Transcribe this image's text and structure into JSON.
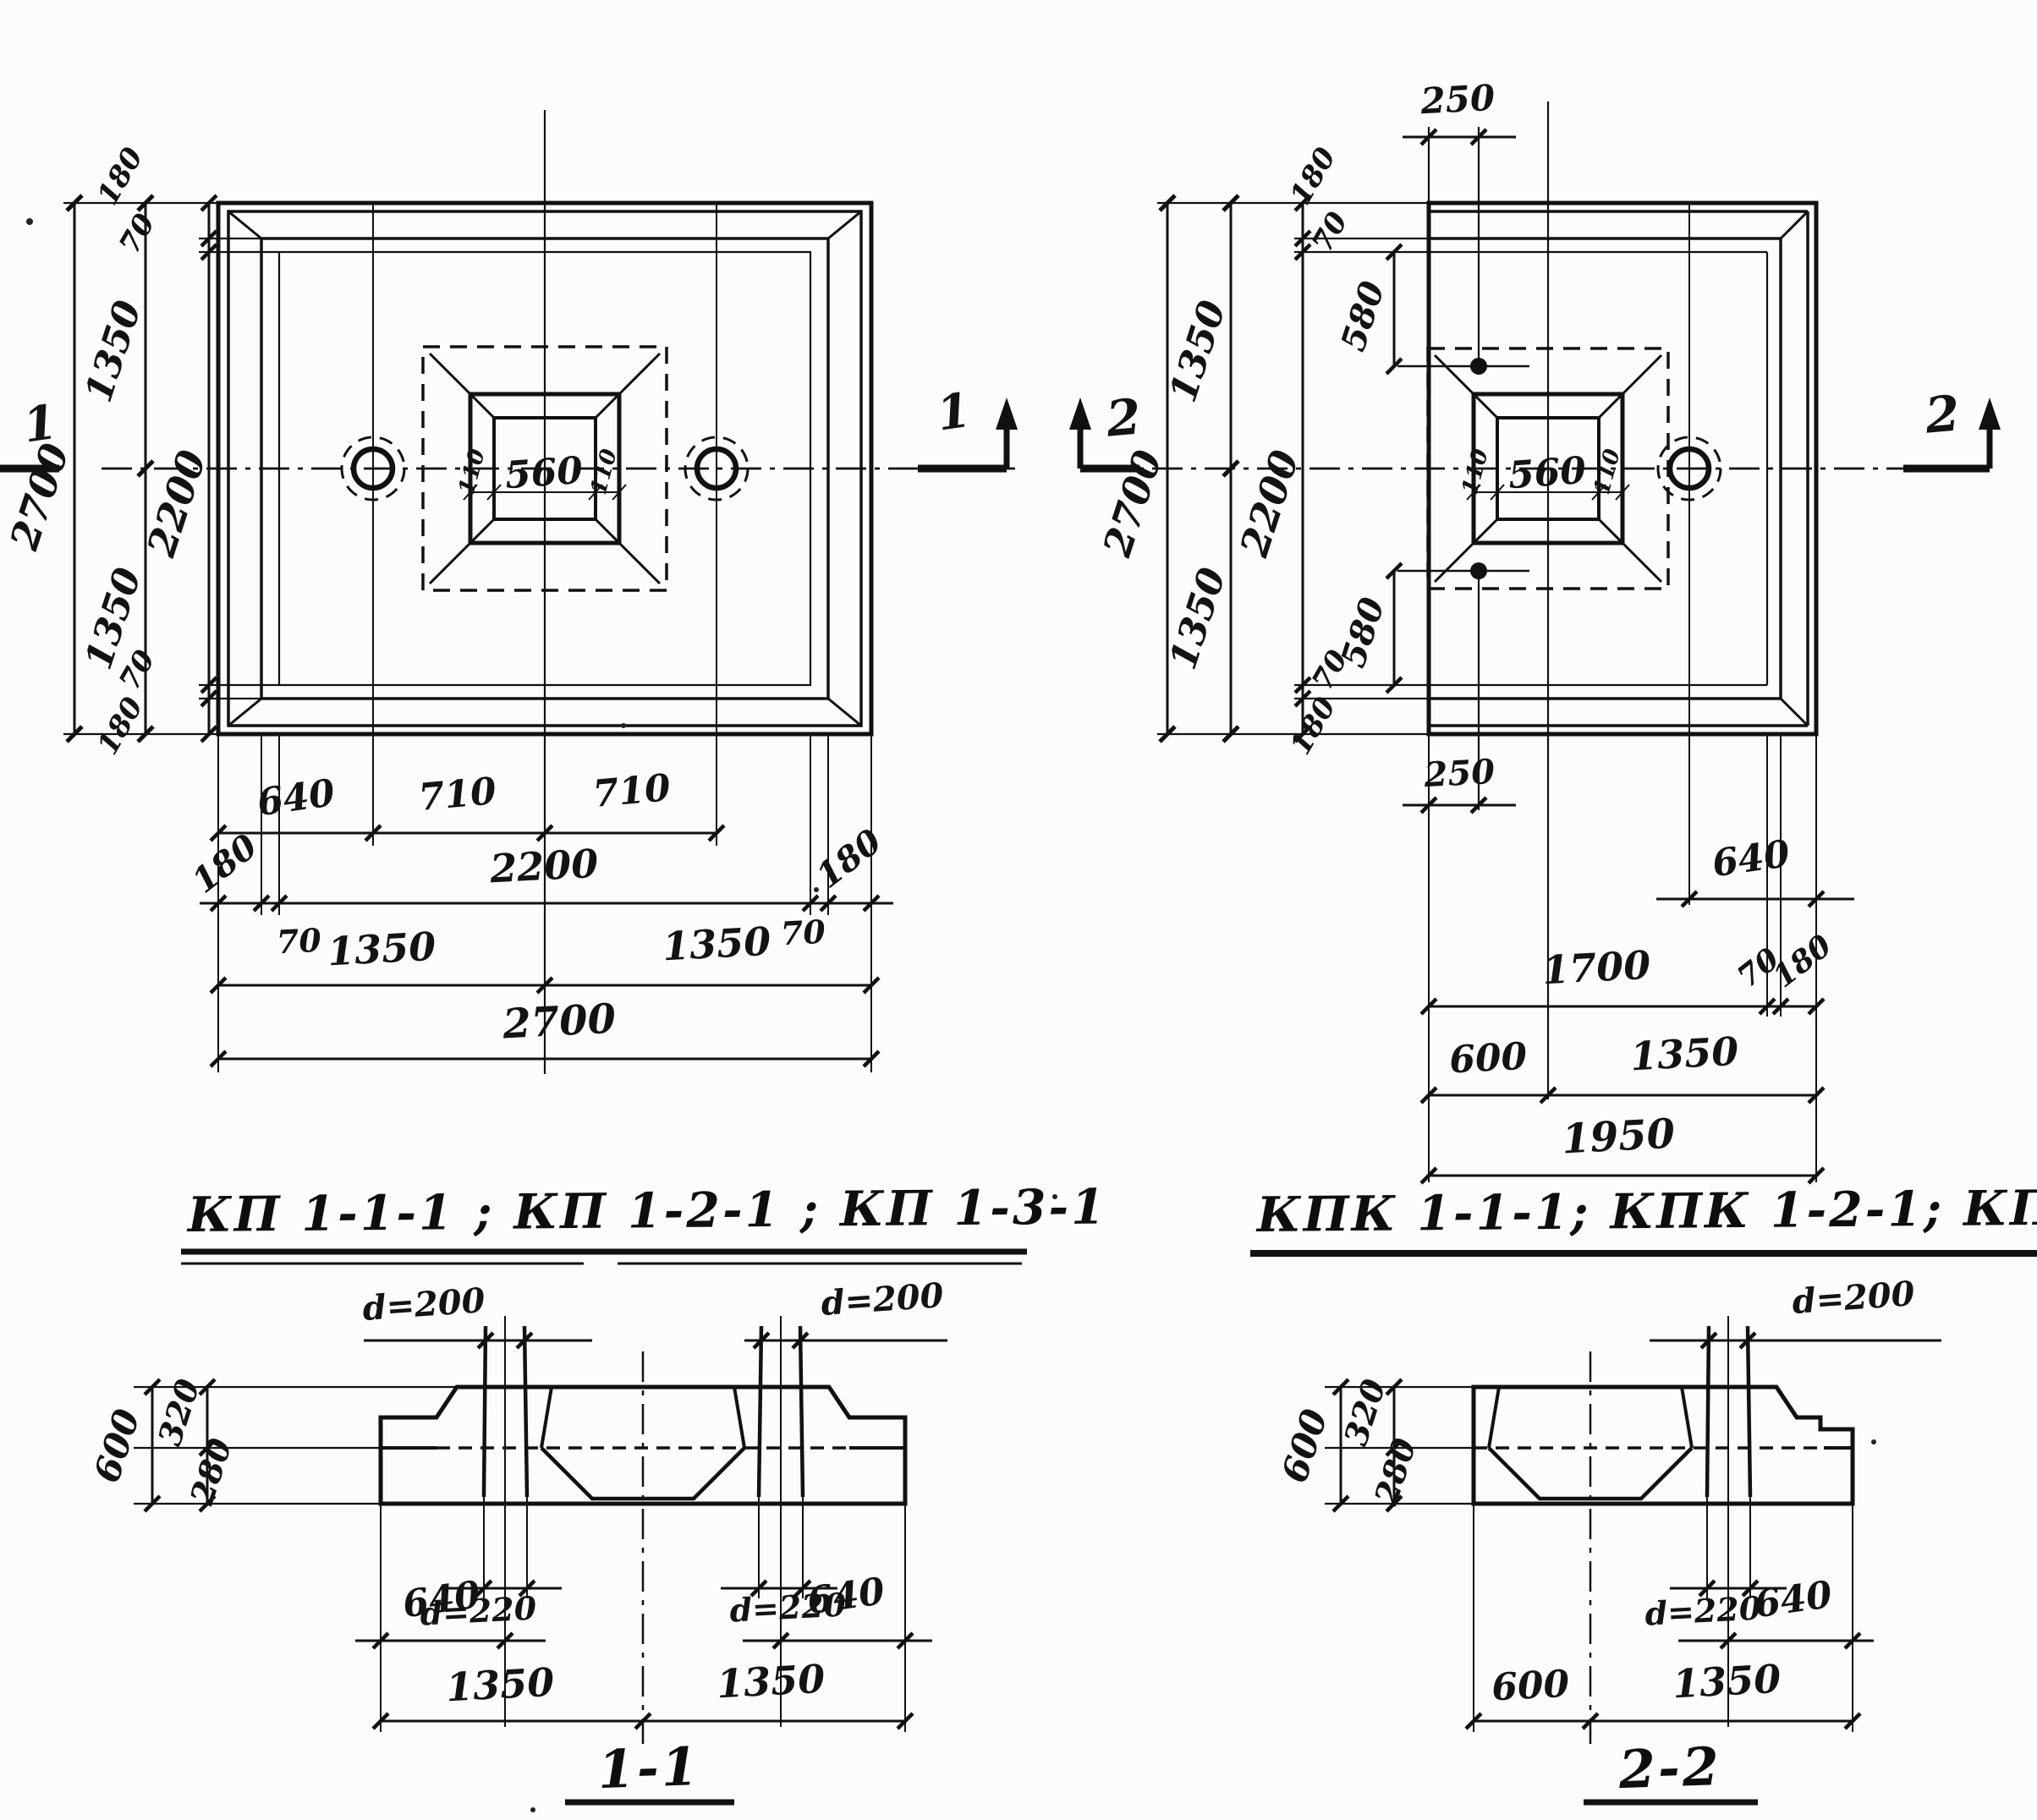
{
  "titles": {
    "kp": "КП 1-1-1 ; КП 1-2-1 ;  КП 1-3-1",
    "kpk": "КПК 1-1-1; КПК 1-2-1; КПК 1-3-1"
  },
  "plan_kp": {
    "section_mark_left": "1",
    "section_mark_right": "1",
    "pocket": "560",
    "pocket_wall_left": "110",
    "pocket_wall_right": "110",
    "left_dims": {
      "total": "2700",
      "half_top": "1350",
      "half_bottom": "1350",
      "inner": "2200",
      "edge_top": "180",
      "step_top": "70",
      "step_bottom": "70",
      "edge_bottom": "180"
    },
    "bottom_dims": {
      "pile_offset": "640",
      "pile_to_center_left": "710",
      "pile_to_center_right": "710",
      "edge_left": "180",
      "inner": "2200",
      "edge_right": "180",
      "step_left": "70",
      "step_right": "70",
      "half_left": "1350",
      "half_right": "1350",
      "total": "2700"
    }
  },
  "plan_kpk": {
    "section_mark_left": "2",
    "section_mark_right": "2",
    "hole_offset_top": "250",
    "hole_offset_bottom": "250",
    "pocket": "560",
    "pocket_wall_left": "110",
    "pocket_wall_right": "110",
    "left_dims": {
      "total": "2700",
      "half_top": "1350",
      "half_bottom": "1350",
      "inner": "2200",
      "edge_top": "180",
      "step_top": "70",
      "hole_top": "580",
      "hole_bottom": "580",
      "step_bottom": "70",
      "edge_bottom": "180"
    },
    "bottom_dims": {
      "pile_offset": "640",
      "inner": "1700",
      "step": "70",
      "edge": "180",
      "cut_to_center": "600",
      "half_right": "1350",
      "total": "1950"
    }
  },
  "section_1_1": {
    "label": "1-1",
    "pile_dia_left": "d=200",
    "pile_dia_right": "d=200",
    "pile_bottom_dia_left": "d=220",
    "pile_bottom_dia_right": "d=220",
    "height_total": "600",
    "height_top": "320",
    "height_bottom": "280",
    "pile_offset_left": "640",
    "pile_offset_right": "640",
    "half_left": "1350",
    "half_right": "1350"
  },
  "section_2_2": {
    "label": "2-2",
    "pile_dia": "d=200",
    "pile_bottom_dia": "d=220",
    "height_total": "600",
    "height_top": "320",
    "height_bottom": "280",
    "pile_offset": "640",
    "cut_to_center": "600",
    "half_right": "1350"
  }
}
